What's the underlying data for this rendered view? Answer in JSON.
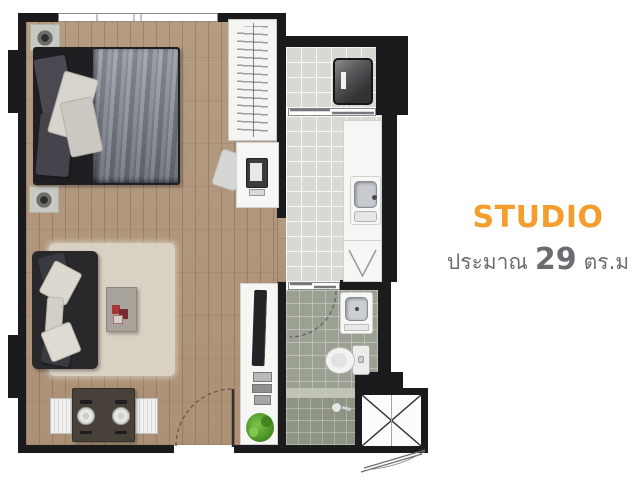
{
  "caption": {
    "title": "STUDIO",
    "area_prefix": "ประมาณ",
    "area_value": "29",
    "area_suffix": "ตร.ม"
  },
  "colors": {
    "accent_orange": "#F59E2D",
    "subtitle_gray": "#6A6C6F",
    "wall": "#1B1B1D",
    "wood": "#B59B80",
    "wood_dark": "#AC9176",
    "tile_light": "#D8D9D3",
    "tile_bath": "#9BA192",
    "tile_shower": "#8D9484",
    "rug": "#D9D1C3",
    "sofa": "#29292C",
    "bed_frame": "#1F1F22"
  },
  "floorplan": {
    "unit_type": "STUDIO",
    "approx_area_sqm": 29,
    "rooms": [
      "sleeping-living-area",
      "kitchen-corridor",
      "balcony-laundry",
      "bathroom",
      "service-shaft"
    ],
    "furniture": [
      "double-bed",
      "bedside-speakers",
      "wardrobe",
      "desk-with-computer",
      "desk-chair",
      "tv-console",
      "tv",
      "books",
      "plant",
      "sofa",
      "rug",
      "coffee-table",
      "dining-table",
      "dining-chairs",
      "washing-machine",
      "kitchen-counter",
      "kitchen-sink",
      "cooktop",
      "washbasin",
      "toilet",
      "shower"
    ]
  }
}
